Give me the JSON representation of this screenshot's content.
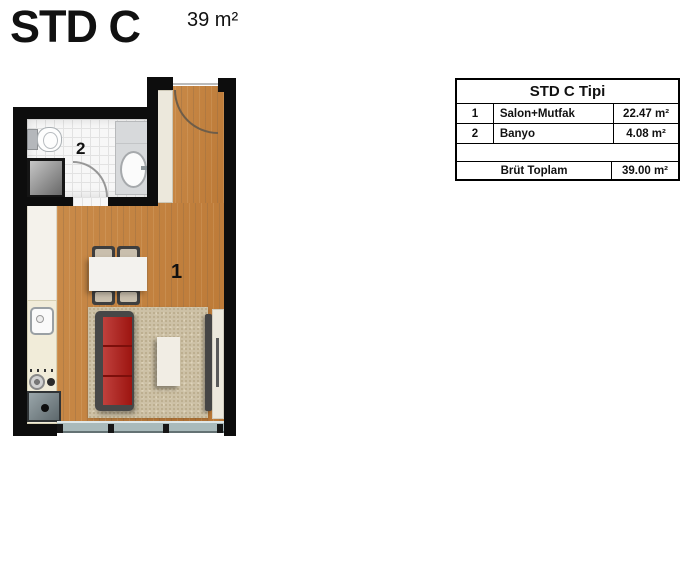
{
  "header": {
    "title": "STD C",
    "area": "39 m²"
  },
  "floorplan": {
    "room_labels": {
      "living": "1",
      "bath": "2"
    }
  },
  "info_table": {
    "title": "STD C Tipi",
    "rows": [
      {
        "no": "1",
        "name": "Salon+Mutfak",
        "area": "22.47 m²"
      },
      {
        "no": "2",
        "name": "Banyo",
        "area": "4.08 m²"
      }
    ],
    "total_label": "Brüt Toplam",
    "total_value": "39.00 m²"
  },
  "colors": {
    "wall": "#0d0d0d",
    "wood": "#c28345",
    "tile": "#f7f7f7",
    "rug": "#cdc1a6",
    "sofa_red": "#b21712",
    "counter": "#f1ecd9",
    "closet": "#ece8dc",
    "window": "#a9babb",
    "text": "#111111"
  }
}
